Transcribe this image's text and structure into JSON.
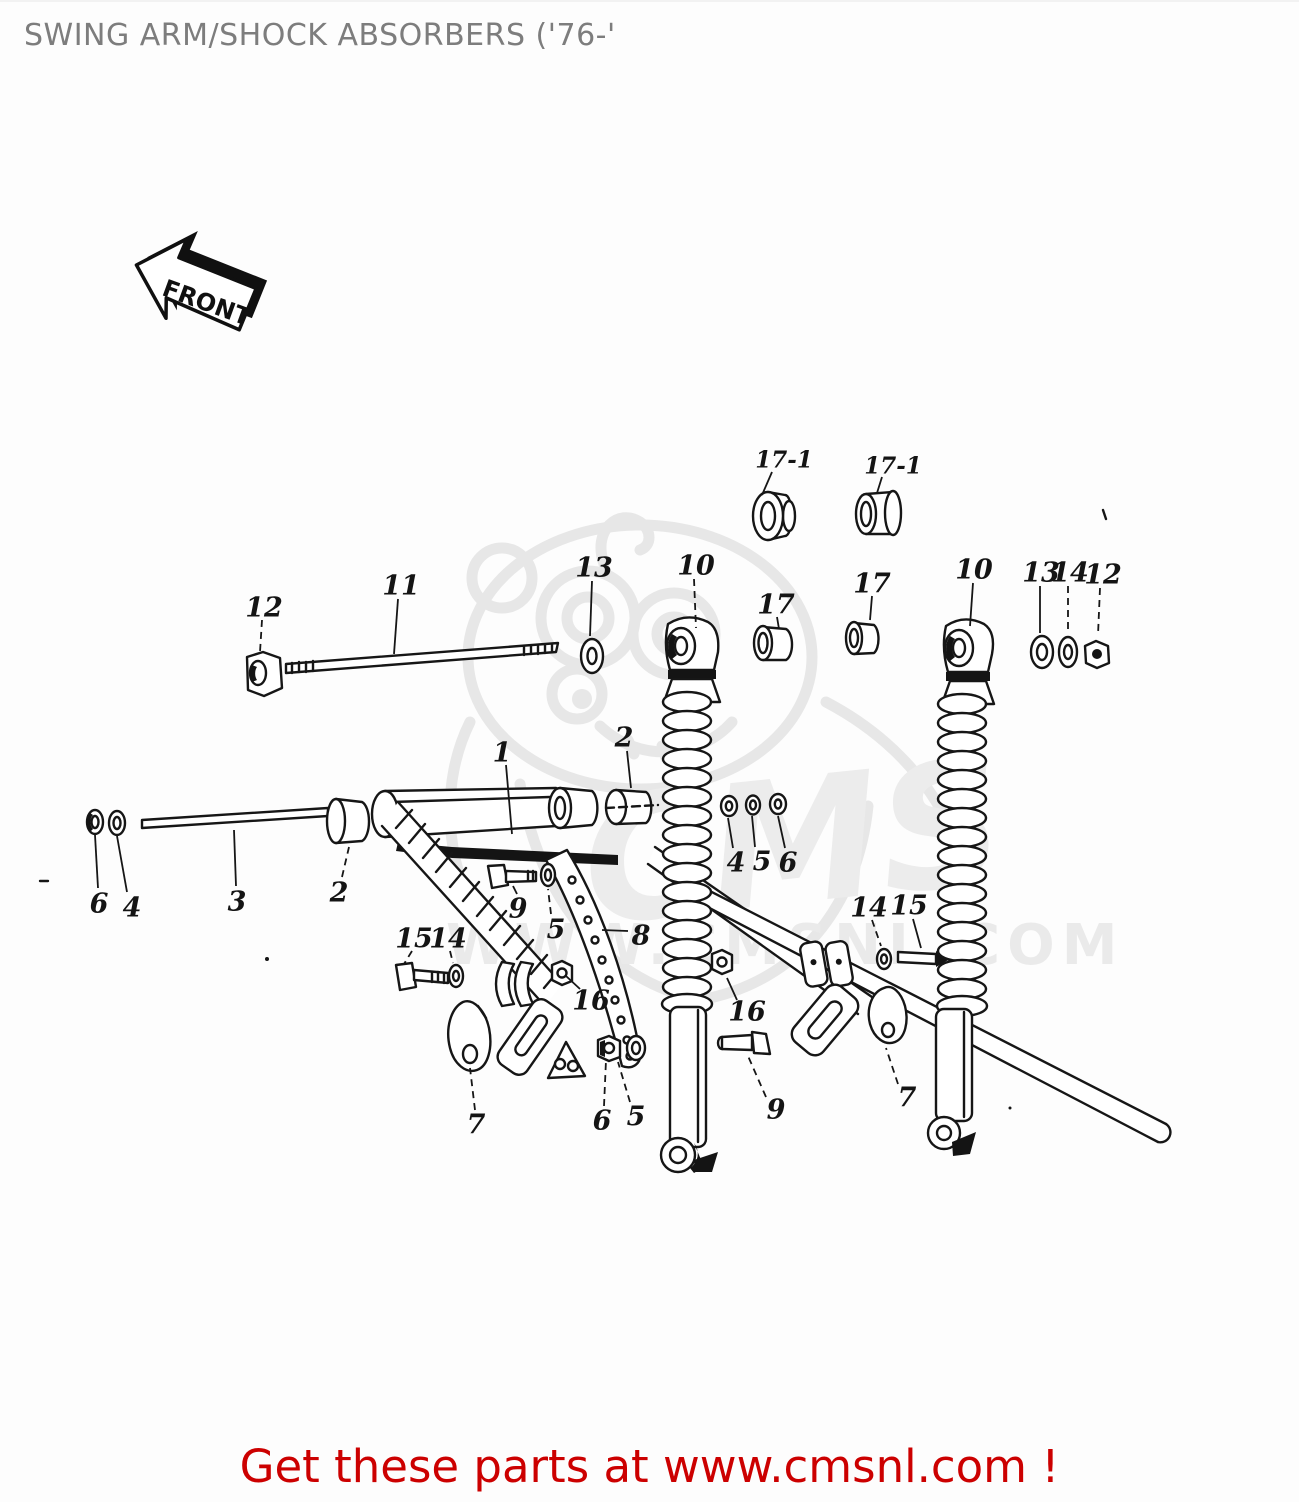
{
  "page": {
    "title": "SWING ARM/SHOCK ABSORBERS ('76-'",
    "footer": "Get these parts at www.cmsnl.com !"
  },
  "watermark": {
    "brand": "CMS",
    "url": "WWW.CMSNL.COM"
  },
  "colors": {
    "line": "#161616",
    "title_gray": "#7d7d7d",
    "footer_red": "#cc0000",
    "watermark_gray": "#ececec"
  },
  "diagram": {
    "front_label": "FRONT",
    "callouts": [
      {
        "text": "17-1",
        "x": 784,
        "y": 457,
        "lx1": 772,
        "ly1": 470,
        "lx2": 762,
        "ly2": 493,
        "dashed": false,
        "size": 23
      },
      {
        "text": "17-1",
        "x": 893,
        "y": 463,
        "lx1": 882,
        "ly1": 475,
        "lx2": 877,
        "ly2": 491,
        "dashed": false,
        "size": 23
      },
      {
        "text": "12",
        "x": 264,
        "y": 605,
        "lx1": 262,
        "ly1": 618,
        "lx2": 260,
        "ly2": 650,
        "dashed": true,
        "size": 27
      },
      {
        "text": "11",
        "x": 401,
        "y": 583,
        "lx1": 398,
        "ly1": 597,
        "lx2": 394,
        "ly2": 652,
        "dashed": false,
        "size": 27
      },
      {
        "text": "13",
        "x": 594,
        "y": 565,
        "lx1": 592,
        "ly1": 579,
        "lx2": 590,
        "ly2": 634,
        "dashed": false,
        "size": 27
      },
      {
        "text": "10",
        "x": 696,
        "y": 563,
        "lx1": 694,
        "ly1": 577,
        "lx2": 696,
        "ly2": 626,
        "dashed": true,
        "size": 27
      },
      {
        "text": "17",
        "x": 776,
        "y": 602,
        "lx1": 777,
        "ly1": 615,
        "lx2": 779,
        "ly2": 627,
        "dashed": false,
        "size": 27
      },
      {
        "text": "17",
        "x": 872,
        "y": 581,
        "lx1": 872,
        "ly1": 594,
        "lx2": 870,
        "ly2": 618,
        "dashed": false,
        "size": 27
      },
      {
        "text": "10",
        "x": 974,
        "y": 567,
        "lx1": 973,
        "ly1": 581,
        "lx2": 970,
        "ly2": 624,
        "dashed": false,
        "size": 27
      },
      {
        "text": "13",
        "x": 1041,
        "y": 570,
        "lx1": 1040,
        "ly1": 584,
        "lx2": 1040,
        "ly2": 631,
        "dashed": false,
        "size": 27
      },
      {
        "text": "14",
        "x": 1070,
        "y": 570,
        "lx1": 1068,
        "ly1": 584,
        "lx2": 1068,
        "ly2": 631,
        "dashed": true,
        "size": 27
      },
      {
        "text": "12",
        "x": 1103,
        "y": 572,
        "lx1": 1100,
        "ly1": 586,
        "lx2": 1098,
        "ly2": 633,
        "dashed": true,
        "size": 27
      },
      {
        "text": "1",
        "x": 502,
        "y": 750,
        "lx1": 506,
        "ly1": 763,
        "lx2": 512,
        "ly2": 832,
        "dashed": false,
        "size": 27
      },
      {
        "text": "2",
        "x": 624,
        "y": 735,
        "lx1": 627,
        "ly1": 749,
        "lx2": 631,
        "ly2": 786,
        "dashed": false,
        "size": 27
      },
      {
        "text": "4",
        "x": 736,
        "y": 860,
        "lx1": 733,
        "ly1": 846,
        "lx2": 728,
        "ly2": 816,
        "dashed": false,
        "size": 27
      },
      {
        "text": "5",
        "x": 762,
        "y": 859,
        "lx1": 755,
        "ly1": 845,
        "lx2": 752,
        "ly2": 814,
        "dashed": false,
        "size": 27
      },
      {
        "text": "6",
        "x": 788,
        "y": 860,
        "lx1": 785,
        "ly1": 846,
        "lx2": 778,
        "ly2": 814,
        "dashed": false,
        "size": 27
      },
      {
        "text": "6",
        "x": 99,
        "y": 901,
        "lx1": 98,
        "ly1": 886,
        "lx2": 95,
        "ly2": 833,
        "dashed": false,
        "size": 27
      },
      {
        "text": "4",
        "x": 132,
        "y": 905,
        "lx1": 127,
        "ly1": 890,
        "lx2": 117,
        "ly2": 834,
        "dashed": false,
        "size": 27
      },
      {
        "text": "3",
        "x": 237,
        "y": 899,
        "lx1": 236,
        "ly1": 884,
        "lx2": 234,
        "ly2": 828,
        "dashed": false,
        "size": 27
      },
      {
        "text": "2",
        "x": 339,
        "y": 890,
        "lx1": 342,
        "ly1": 875,
        "lx2": 349,
        "ly2": 845,
        "dashed": true,
        "size": 27
      },
      {
        "text": "15",
        "x": 414,
        "y": 936,
        "lx1": 412,
        "ly1": 949,
        "lx2": 404,
        "ly2": 962,
        "dashed": true,
        "size": 27
      },
      {
        "text": "14",
        "x": 448,
        "y": 936,
        "lx1": 450,
        "ly1": 949,
        "lx2": 453,
        "ly2": 961,
        "dashed": true,
        "size": 27
      },
      {
        "text": "9",
        "x": 518,
        "y": 906,
        "lx1": 517,
        "ly1": 892,
        "lx2": 513,
        "ly2": 884,
        "dashed": false,
        "size": 27
      },
      {
        "text": "5",
        "x": 556,
        "y": 927,
        "lx1": 551,
        "ly1": 912,
        "lx2": 548,
        "ly2": 887,
        "dashed": true,
        "size": 27
      },
      {
        "text": "8",
        "x": 641,
        "y": 933,
        "lx1": 628,
        "ly1": 929,
        "lx2": 602,
        "ly2": 928,
        "dashed": false,
        "size": 27
      },
      {
        "text": "16",
        "x": 591,
        "y": 998,
        "lx1": 580,
        "ly1": 987,
        "lx2": 566,
        "ly2": 974,
        "dashed": false,
        "size": 27
      },
      {
        "text": "14",
        "x": 869,
        "y": 905,
        "lx1": 872,
        "ly1": 918,
        "lx2": 881,
        "ly2": 944,
        "dashed": true,
        "size": 27
      },
      {
        "text": "15",
        "x": 909,
        "y": 903,
        "lx1": 913,
        "ly1": 917,
        "lx2": 921,
        "ly2": 946,
        "dashed": false,
        "size": 27
      },
      {
        "text": "16",
        "x": 747,
        "y": 1009,
        "lx1": 737,
        "ly1": 998,
        "lx2": 727,
        "ly2": 976,
        "dashed": false,
        "size": 27
      },
      {
        "text": "7",
        "x": 476,
        "y": 1122,
        "lx1": 475,
        "ly1": 1108,
        "lx2": 470,
        "ly2": 1066,
        "dashed": true,
        "size": 27
      },
      {
        "text": "6",
        "x": 602,
        "y": 1118,
        "lx1": 604,
        "ly1": 1104,
        "lx2": 606,
        "ly2": 1058,
        "dashed": true,
        "size": 27
      },
      {
        "text": "5",
        "x": 636,
        "y": 1114,
        "lx1": 630,
        "ly1": 1100,
        "lx2": 618,
        "ly2": 1060,
        "dashed": true,
        "size": 27
      },
      {
        "text": "9",
        "x": 776,
        "y": 1107,
        "lx1": 766,
        "ly1": 1095,
        "lx2": 748,
        "ly2": 1054,
        "dashed": true,
        "size": 27
      },
      {
        "text": "7",
        "x": 907,
        "y": 1095,
        "lx1": 898,
        "ly1": 1082,
        "lx2": 886,
        "ly2": 1046,
        "dashed": true,
        "size": 27
      }
    ]
  }
}
